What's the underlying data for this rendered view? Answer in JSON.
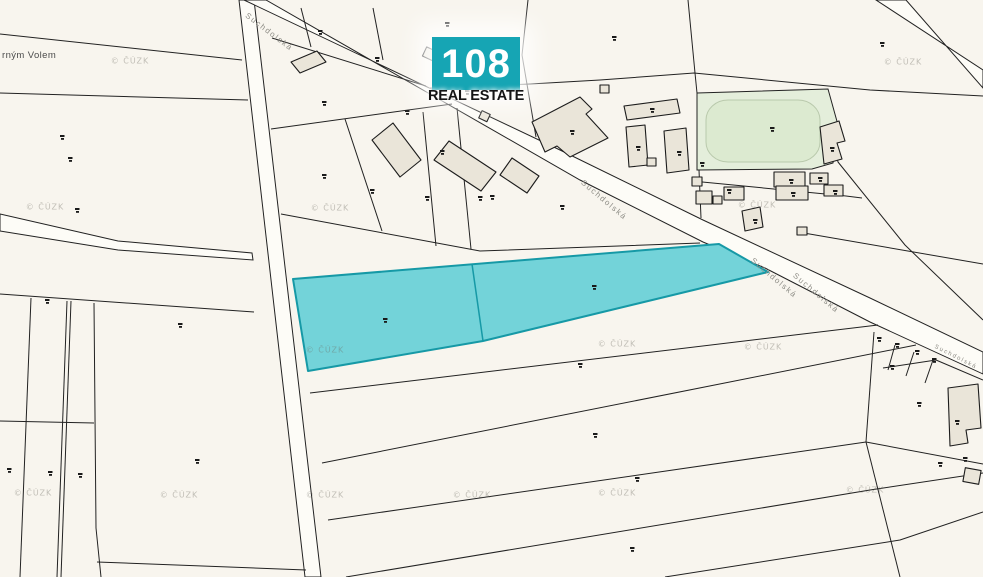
{
  "logo": {
    "number": "108",
    "subtitle": "REAL ESTATE",
    "bg_color": "#16a5b4"
  },
  "map": {
    "background": "#f8f5ee",
    "line_color": "#222222",
    "road_fill": "#fdfcf7",
    "building_fill": "#eae5d9",
    "green_fill": "#e4eedb",
    "green_inner_fill": "#dcead0",
    "highlight_fill": "#73d3d9",
    "highlight_stroke": "#1699a6",
    "place_partial": "rným Volem"
  },
  "street_labels": [
    {
      "text": "Suchdolská",
      "x": 249,
      "y": 11,
      "rot": 37,
      "size": 8
    },
    {
      "text": "Suchdolská",
      "x": 585,
      "y": 178,
      "rot": 40,
      "size": 8
    },
    {
      "text": "Suchdolská",
      "x": 755,
      "y": 256,
      "rot": 40,
      "size": 8
    },
    {
      "text": "Suchdolská",
      "x": 797,
      "y": 271,
      "rot": 40,
      "size": 8
    },
    {
      "text": "Suchdolská",
      "x": 936,
      "y": 344,
      "rot": 27,
      "size": 6
    }
  ],
  "watermark": {
    "text": "© ČÚZK",
    "positions": [
      [
        130,
        61
      ],
      [
        903,
        62
      ],
      [
        45,
        207
      ],
      [
        330,
        208
      ],
      [
        757,
        205
      ],
      [
        325,
        350
      ],
      [
        617,
        344
      ],
      [
        763,
        347
      ],
      [
        33,
        493
      ],
      [
        179,
        495
      ],
      [
        325,
        495
      ],
      [
        472,
        495
      ],
      [
        617,
        493
      ],
      [
        865,
        490
      ]
    ]
  },
  "parcel_marks": [
    [
      60,
      135
    ],
    [
      68,
      157
    ],
    [
      75,
      208
    ],
    [
      45,
      299
    ],
    [
      178,
      323
    ],
    [
      7,
      468
    ],
    [
      48,
      471
    ],
    [
      78,
      473
    ],
    [
      195,
      459
    ],
    [
      322,
      174
    ],
    [
      478,
      196
    ],
    [
      383,
      318
    ],
    [
      592,
      285
    ],
    [
      578,
      363
    ],
    [
      593,
      433
    ],
    [
      635,
      477
    ],
    [
      630,
      547
    ],
    [
      318,
      30
    ],
    [
      375,
      57
    ],
    [
      445,
      22
    ],
    [
      322,
      101
    ],
    [
      405,
      110
    ],
    [
      465,
      90
    ],
    [
      612,
      36
    ],
    [
      880,
      42
    ],
    [
      570,
      130
    ],
    [
      650,
      108
    ],
    [
      636,
      146
    ],
    [
      677,
      151
    ],
    [
      700,
      162
    ],
    [
      753,
      219
    ],
    [
      789,
      179
    ],
    [
      791,
      192
    ],
    [
      833,
      190
    ],
    [
      818,
      177
    ],
    [
      830,
      147
    ],
    [
      770,
      127
    ],
    [
      727,
      189
    ],
    [
      440,
      150
    ],
    [
      370,
      189
    ],
    [
      425,
      196
    ],
    [
      490,
      195
    ],
    [
      560,
      205
    ],
    [
      895,
      343
    ],
    [
      915,
      350
    ],
    [
      932,
      358
    ],
    [
      890,
      365
    ],
    [
      917,
      402
    ],
    [
      955,
      420
    ],
    [
      938,
      462
    ],
    [
      963,
      457
    ],
    [
      877,
      337
    ]
  ]
}
